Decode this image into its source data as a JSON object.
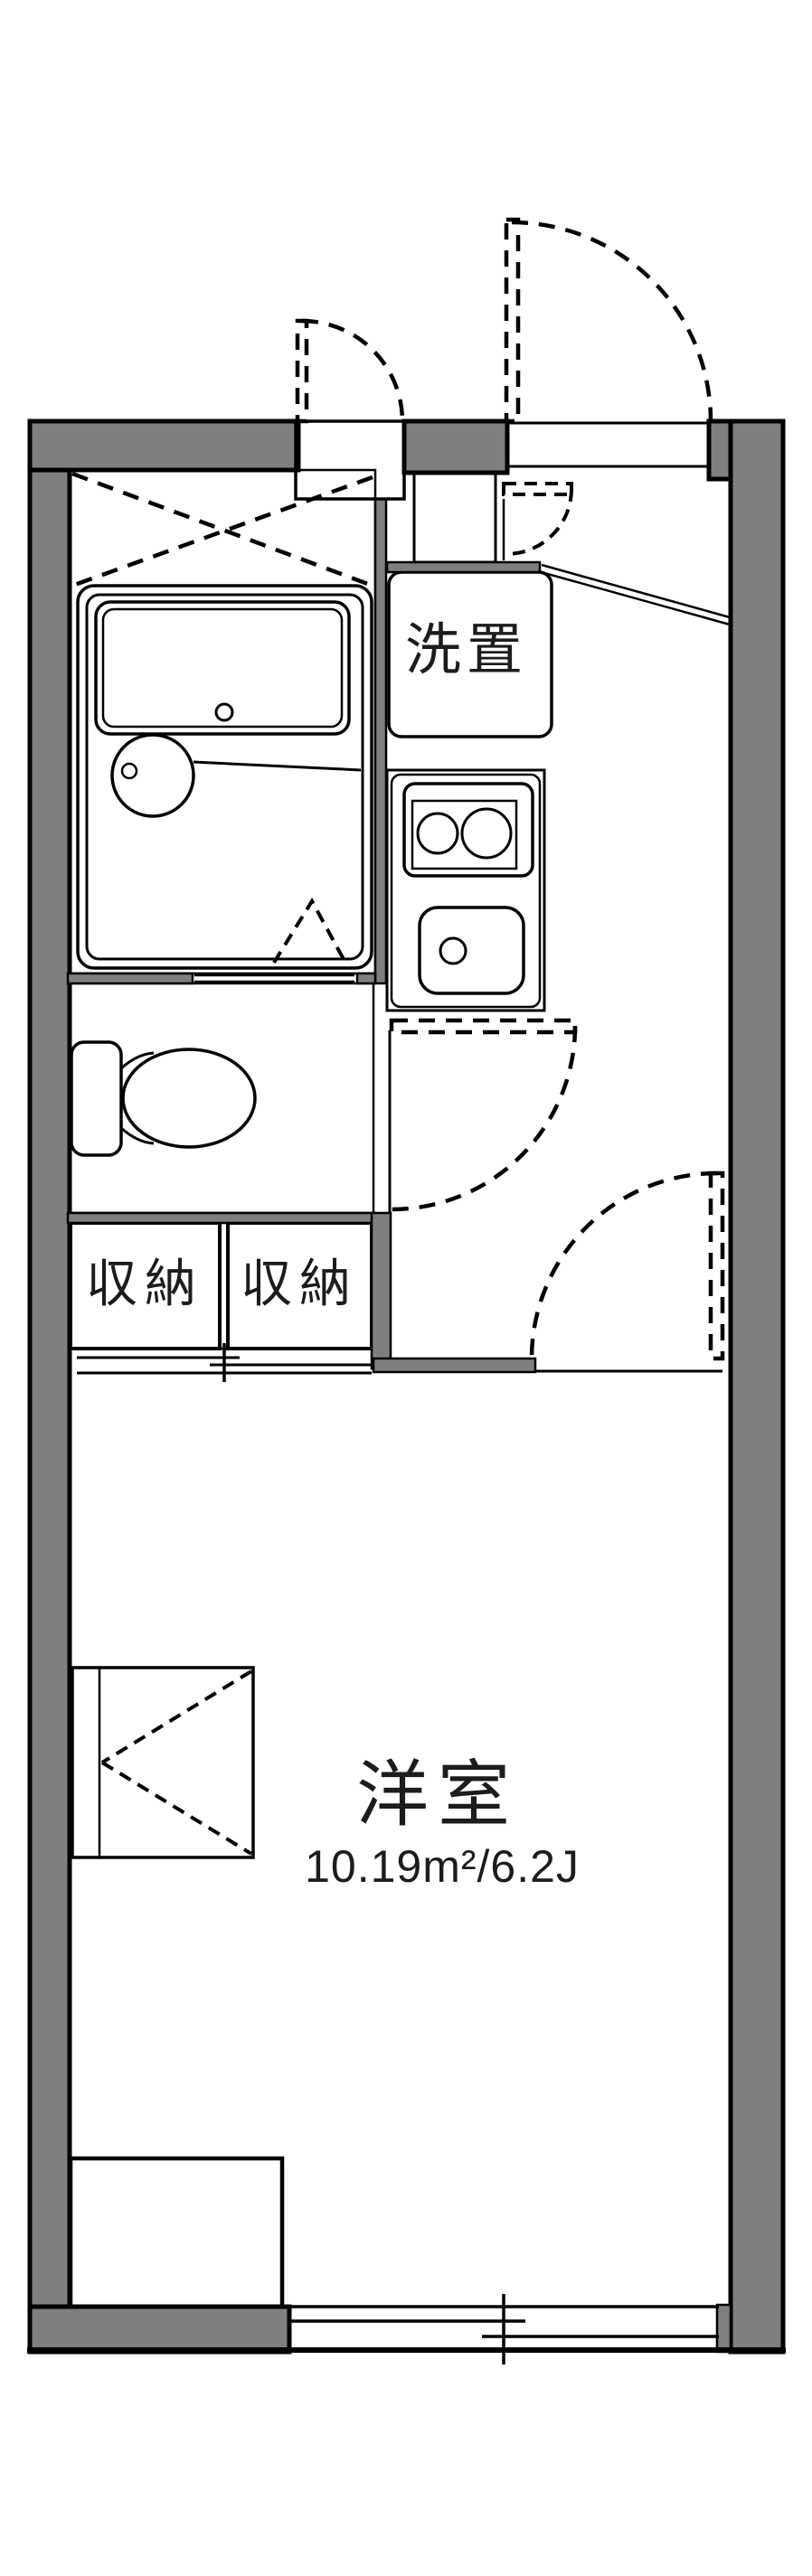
{
  "plan": {
    "type": "apartment-floor-plan",
    "labels": {
      "laundry": "洗置",
      "storage_left": "収納",
      "storage_right": "収納",
      "room_name": "洋室",
      "room_area": "10.19m²/6.2J"
    },
    "colors": {
      "wall": "#7f7f7f",
      "line": "#000000",
      "water": "#dbe7f8",
      "storage": "#fcf2de",
      "bg": "#ffffff",
      "text": "#1c1c1c"
    }
  }
}
